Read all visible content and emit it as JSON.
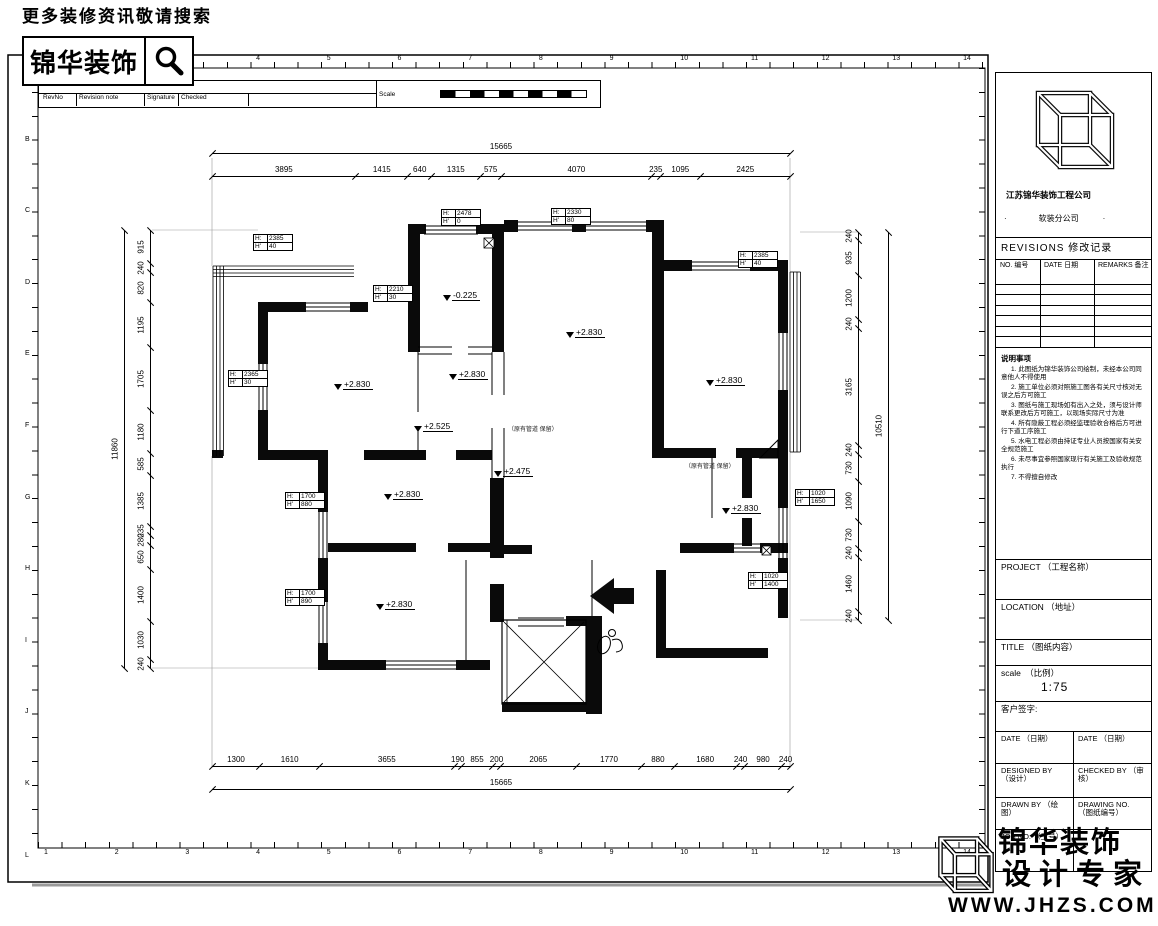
{
  "header": {
    "tagline": "更多装修资讯敬请搜索",
    "logo_text": "锦华装饰",
    "search_icon": "magnifier-icon"
  },
  "frame": {
    "row_letters": [
      "A",
      "B",
      "C",
      "D",
      "E",
      "F",
      "G",
      "H",
      "I",
      "J",
      "K",
      "L"
    ],
    "col_numbers": [
      "1",
      "2",
      "3",
      "4",
      "5",
      "6",
      "7",
      "8",
      "9",
      "10",
      "11",
      "12",
      "13",
      "14"
    ]
  },
  "revision_strip": {
    "cells": [
      "RevNo",
      "Revision note",
      "Signature",
      "Checked"
    ],
    "scale_label": "Scale"
  },
  "plan": {
    "chains": {
      "top": {
        "total": "15665",
        "segments": [
          "3895",
          "1415",
          "640",
          "1315",
          "575",
          "4070",
          "235",
          "1095",
          "2425"
        ]
      },
      "bottom": {
        "total": "15665",
        "segments": [
          "1300",
          "1610",
          "3655",
          "190",
          "855",
          "200",
          "2065",
          "1770",
          "880",
          "1680",
          "240",
          "980",
          "240"
        ]
      },
      "left": {
        "total": "11860",
        "segments": [
          "915",
          "240",
          "820",
          "1195",
          "1705",
          "1180",
          "585",
          "1385",
          "235",
          "280",
          "650",
          "1400",
          "1030",
          "240"
        ]
      },
      "right": {
        "total": "10510",
        "segments": [
          "240",
          "935",
          "1200",
          "240",
          "3165",
          "240",
          "730",
          "1090",
          "730",
          "240",
          "1460",
          "240"
        ]
      }
    },
    "levels": [
      {
        "label": "-0.225",
        "x": 443,
        "y": 290
      },
      {
        "label": "+2.830",
        "x": 566,
        "y": 327
      },
      {
        "label": "+2.830",
        "x": 334,
        "y": 379
      },
      {
        "label": "+2.830",
        "x": 449,
        "y": 369
      },
      {
        "label": "+2.830",
        "x": 706,
        "y": 375
      },
      {
        "label": "+2.525",
        "x": 414,
        "y": 421
      },
      {
        "label": "+2.475",
        "x": 494,
        "y": 466
      },
      {
        "label": "+2.830",
        "x": 384,
        "y": 489
      },
      {
        "label": "+2.830",
        "x": 722,
        "y": 503
      },
      {
        "label": "+2.830",
        "x": 376,
        "y": 599
      }
    ],
    "tags": {
      "row1_prefix": "H:",
      "row2_prefix": "H'",
      "items": [
        {
          "v1": "2385",
          "v2": "40",
          "x": 253,
          "y": 234
        },
        {
          "v1": "2478",
          "v2": "0",
          "x": 441,
          "y": 209
        },
        {
          "v1": "2330",
          "v2": "80",
          "x": 551,
          "y": 208
        },
        {
          "v1": "2385",
          "v2": "40",
          "x": 738,
          "y": 251
        },
        {
          "v1": "2210",
          "v2": "30",
          "x": 373,
          "y": 285
        },
        {
          "v1": "2365",
          "v2": "30",
          "x": 228,
          "y": 370
        },
        {
          "v1": "1700",
          "v2": "880",
          "x": 285,
          "y": 492
        },
        {
          "v1": "1700",
          "v2": "890",
          "x": 285,
          "y": 589
        },
        {
          "v1": "1020",
          "v2": "1650",
          "x": 795,
          "y": 489
        },
        {
          "v1": "1020",
          "v2": "1400",
          "x": 748,
          "y": 572
        }
      ]
    },
    "annotations": [
      {
        "text": "（原有管道 保留）",
        "x": 508,
        "y": 424
      },
      {
        "text": "（原有管道 保留）",
        "x": 685,
        "y": 461
      }
    ]
  },
  "titleblock": {
    "company_line1": "江苏锦华装饰工程公司",
    "company_line2": "·　　　　软装分公司　　　·",
    "revisions_title": "REVISIONS 修改记录",
    "rev_cols": [
      "NO. 编号",
      "DATE 日期",
      "REMARKS 备注"
    ],
    "notes_title": "说明事项",
    "notes": [
      "此图纸为锦华装饰公司绘制，未经本公司同意他人不得使用",
      "施工单位必须对照施工图各有关尺寸核对无误之后方可施工",
      "图纸与施工现场如有出入之处，须与设计师联系更改后方可施工，以现场实际尺寸为准",
      "所有隐蔽工程必须经监理验收合格后方可进行下道工序施工",
      "水电工程必须由持证专业人员按国家有关安全规范施工",
      "未尽事宜参照国家现行有关施工及验收规范执行",
      "不得擅自修改"
    ],
    "project_label": "PROJECT （工程名称）",
    "location_label": "LOCATION （地址）",
    "title_label": "TITLE （图纸内容）",
    "scale_label": "scale　（比例）",
    "scale_value": "1:75",
    "client_sign_label": "客户签字:",
    "date_label_1": "DATE （日期）",
    "date_label_2": "DATE （日期）",
    "designed_label": "DESIGNED BY （设计）",
    "checked_label": "CHECKED BY （审核）",
    "drawn_label": "DRAWN BY （绘图）",
    "drawing_no_label": "DRAWING NO. （图纸编号）",
    "job_label": "JOB NO. （工号）"
  },
  "watermark": {
    "line1": "锦华装饰",
    "line2": "设计专家",
    "url": "WWW.JHZS.COM"
  }
}
